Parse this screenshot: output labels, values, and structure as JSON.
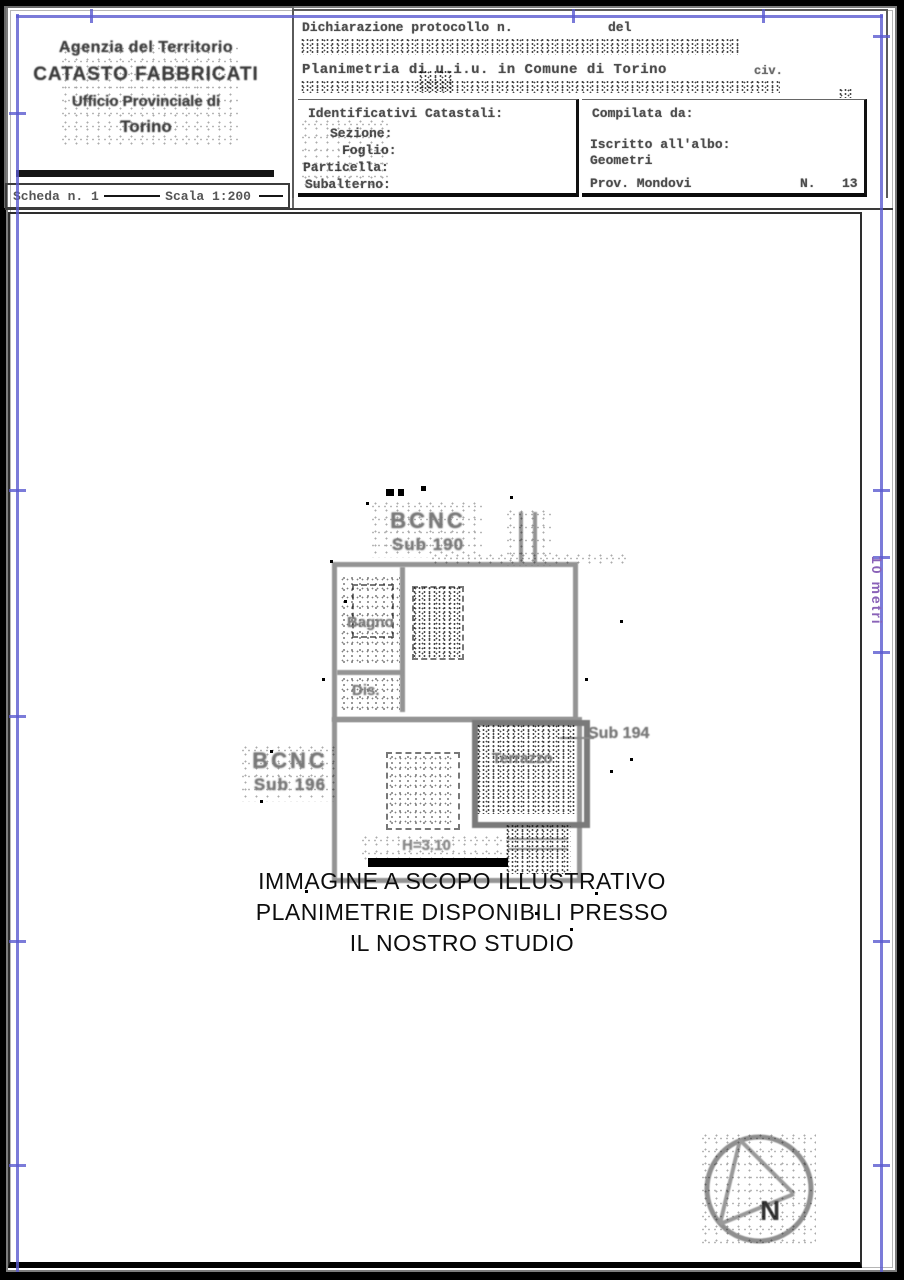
{
  "header": {
    "agency": {
      "line1": "Agenzia del Territorio",
      "line2": "CATASTO FABBRICATI",
      "line3": "Ufficio Provinciale di",
      "line4": "Torino"
    },
    "scheda_bar": {
      "scheda": "Scheda n. 1",
      "scala": "Scala 1:200"
    },
    "declaration": {
      "protocol_label": "Dichiarazione protocollo n.",
      "del_label": "del",
      "planimetria_line": "Planimetria di u.i.u. in Comune di Torino",
      "civ_label": "civ."
    },
    "identifiers": {
      "title": "Identificativi Catastali:",
      "fields": [
        "Sezione:",
        "Foglio:",
        "Particella:",
        "Subalterno:"
      ]
    },
    "compiler": {
      "title": "Compilata da:",
      "albo_label": "Iscritto all'albo:",
      "albo_value": "Geometri",
      "prov": "Prov. Mondovi",
      "n_label": "N.",
      "n_value": "13"
    }
  },
  "plan": {
    "labels": {
      "bcnc_top_line1": "BCNC",
      "bcnc_top_line2": "Sub 190",
      "bcnc_left_line1": "BCNC",
      "bcnc_left_line2": "Sub 196",
      "sub_right": "Sub 194",
      "bagno": "Bagno",
      "dis": "Dis.",
      "terrazzo": "Terrazzo",
      "height": "H=3.10"
    },
    "scale_text": "10 metri",
    "compass_letter": "N"
  },
  "watermark": {
    "line1": "IMMAGINE A SCOPO ILLUSTRATIVO",
    "line2": "PLANIMETRIE DISPONIBILI PRESSO",
    "line3": "IL NOSTRO STUDIO"
  },
  "colors": {
    "frame_blue": "#5a5ad0",
    "scale_purple": "#8a62b8",
    "scan_gray": "#4c4c4c"
  }
}
